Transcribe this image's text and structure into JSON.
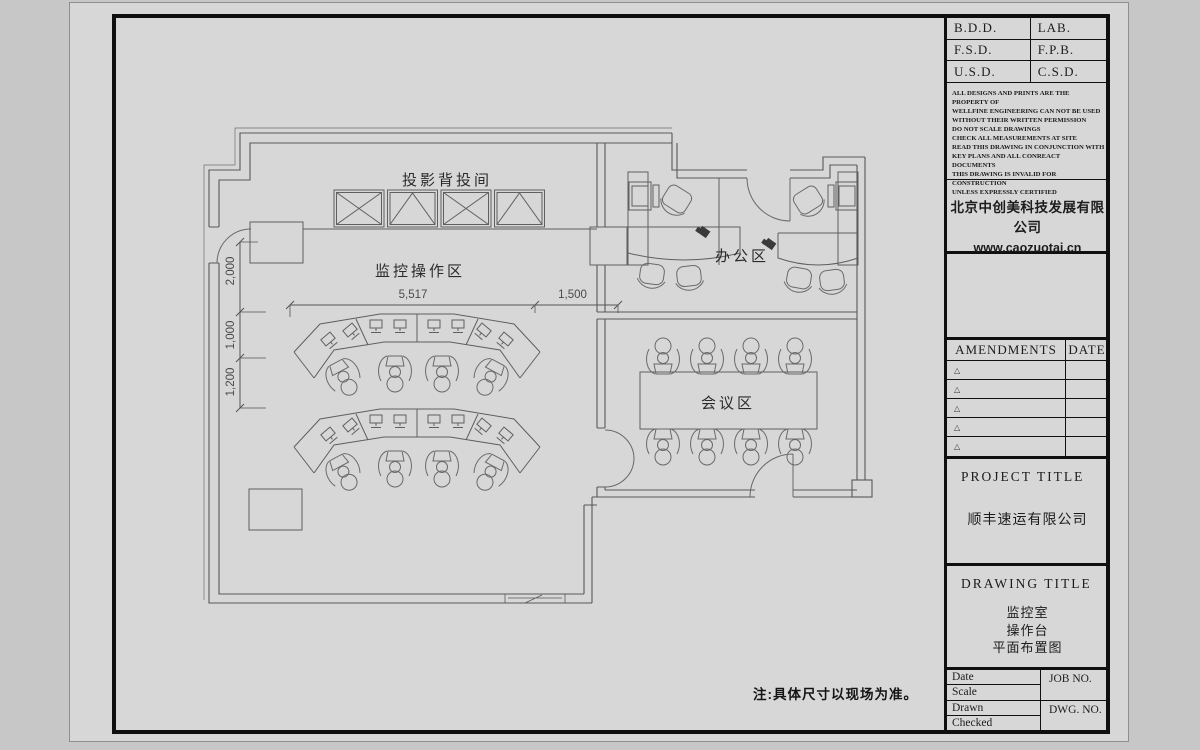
{
  "plan": {
    "area_labels": {
      "projection_room": "投影背投间",
      "monitor_operation": "监控操作区",
      "office": "办公区",
      "meeting": "会议区"
    },
    "dimensions": {
      "v1": "2,000",
      "v2": "1,000",
      "v3": "1,200",
      "h1": "5,517",
      "h2": "1,500"
    },
    "note": "注:具体尺寸以现场为准。"
  },
  "title_block": {
    "stamp": {
      "r1c1": "B.D.D.",
      "r1c2": "LAB.",
      "r2c1": "F.S.D.",
      "r2c2": "F.P.B.",
      "r3c1": "U.S.D.",
      "r3c2": "C.S.D."
    },
    "disclaimer": "ALL DESIGNS AND PRINTS ARE THE PROPERTY OF\nWELLFINE ENGINEERING CAN NOT BE USED\nWITHOUT THEIR WRITTEN PERMISSION\nDO NOT SCALE DRAWINGS\nCHECK ALL MEASUREMENTS AT SITE\nREAD THIS DRAWING IN CONJUNCTION WITH\nKEY PLANS AND ALL CONREACT DOCUMENTS\nTHIS DRAWING IS INVALID FOR CONSTRUCTION\nUNLESS EXPRESSLY CERTIFIED",
    "company": {
      "name": "北京中创美科技发展有限公司",
      "website": "www.caozuotai.cn"
    },
    "amendments": {
      "title": "AMENDMENTS",
      "date": "DATE",
      "marker": "△"
    },
    "project": {
      "label": "PROJECT  TITLE",
      "name": "顺丰速运有限公司"
    },
    "drawing": {
      "label": "DRAWING  TITLE",
      "line1": "监控室",
      "line2": "操作台",
      "line3": "平面布置图"
    },
    "fields": {
      "date": "Date",
      "scale": "Scale",
      "drawn": "Drawn",
      "checked": "Checked",
      "job": "JOB NO.",
      "dwg": "DWG. NO."
    }
  }
}
